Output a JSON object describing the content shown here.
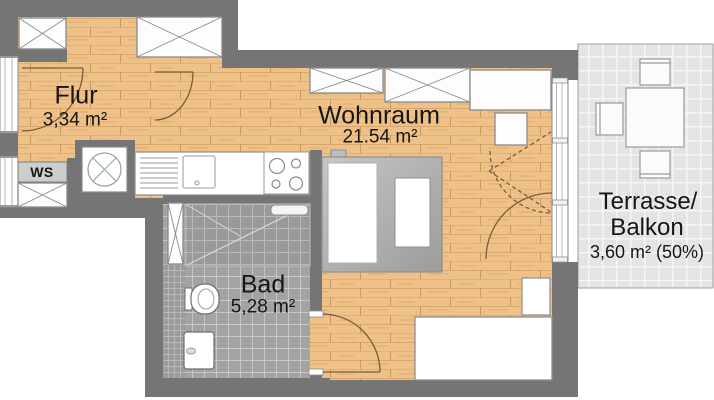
{
  "rooms": {
    "flur": {
      "name": "Flur",
      "area": "3,34 m²"
    },
    "wohnraum": {
      "name": "Wohnraum",
      "area": "21.54 m²"
    },
    "bad": {
      "name": "Bad",
      "area": "5,28 m²"
    },
    "terrasse": {
      "name_line1": "Terrasse/",
      "name_line2": "Balkon",
      "area": "3,60 m² (50%)"
    }
  },
  "labels": {
    "washing_machine_space": "WS"
  },
  "colors": {
    "wall": "#757575",
    "wood_floor": "#eec189",
    "bath_tile": "#a3a3a3",
    "terrace_tile": "#e4e4e4",
    "furniture_outline": "#8a8a8a",
    "door_swing": "#7d5b3a"
  }
}
